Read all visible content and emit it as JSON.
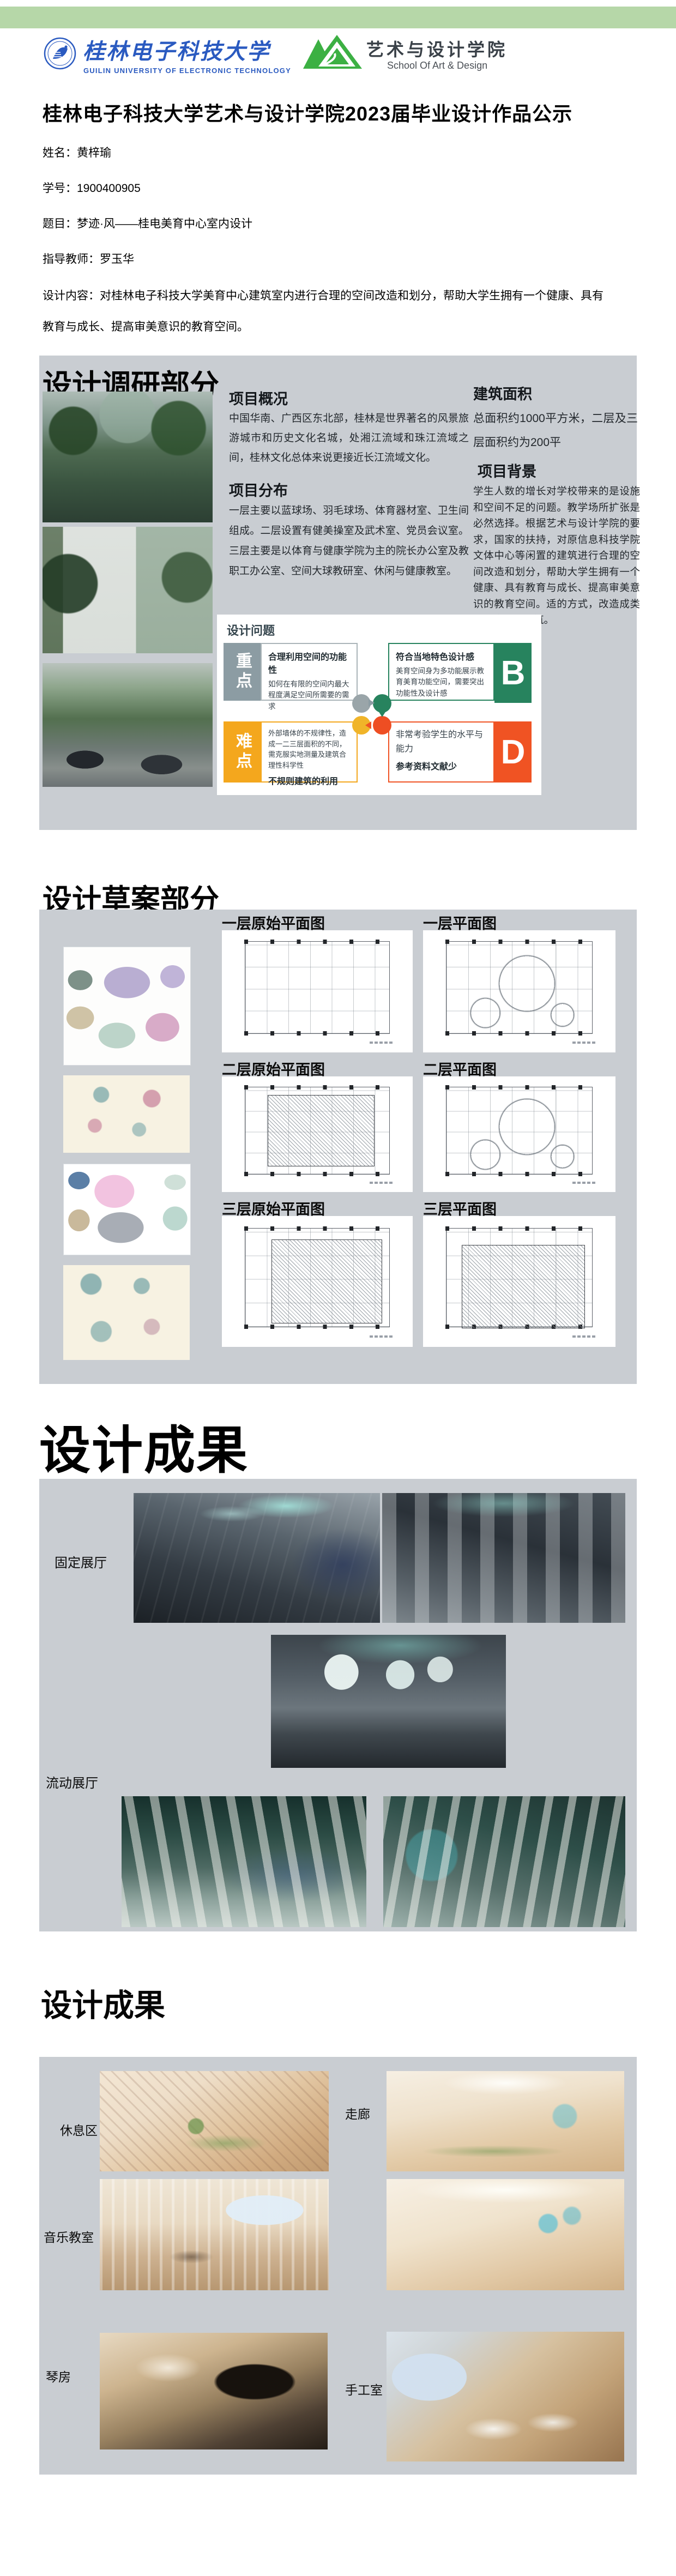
{
  "page": {
    "title": "桂林电子科技大学艺术与设计学院2023届毕业设计作品公示"
  },
  "header": {
    "university": {
      "name_cn": "桂林电子科技大学",
      "name_en": "GUILIN UNIVERSITY OF ELECTRONIC TECHNOLOGY"
    },
    "school": {
      "name_cn": "艺术与设计学院",
      "name_en": "School Of Art & Design"
    }
  },
  "info": {
    "rows": [
      {
        "label": "姓名：",
        "value": "黄梓瑜"
      },
      {
        "label": "学号：",
        "value": "1900400905"
      },
      {
        "label": "题目：",
        "value": "梦迹·风——桂电美育中心室内设计"
      },
      {
        "label": "指导教师：",
        "value": "罗玉华"
      },
      {
        "label": "设计内容：",
        "value": "对桂林电子科技大学美育中心建筑室内进行合理的空间改造和划分，帮助大学生拥有一个健康、具有教育与成长、提高审美意识的教育空间。"
      }
    ]
  },
  "research": {
    "title": "设计调研部分",
    "overview": {
      "heading": "项目概况",
      "body": "中国华南、广西区东北部，桂林是世界著名的风景旅游城市和历史文化名城，处湘江流域和珠江流域之间，桂林文化总体来说更接近长江流域文化。"
    },
    "distribution": {
      "heading": "项目分布",
      "body": "一层主要以蓝球场、羽毛球场、体育器材室、卫生间组成。二层设置有健美操室及武术室、党员会议室。三层主要是以体育与健康学院为主的院长办公室及教职工办公室、空间大球教研室、休闲与健康教室。"
    },
    "area": {
      "heading": "建筑面积",
      "body": "总面积约1000平方米，二层及三层面积约为200平"
    },
    "background": {
      "heading": "项目背景",
      "body": "学生人数的增长对学校带来的是设施和空间不足的问题。教学场所扩张是必然选择。根据艺术与设计学院的要求，国家的扶持，对原信息科技学院文体中心等闲置的建筑进行合理的空间改造和划分，帮助大学生拥有一个健康、具有教育与成长、提高审美意识的教育空间。适的方式，改造成类似美育中心建筑。"
    },
    "problems": {
      "heading": "设计问题",
      "key_label": "重点",
      "difficulty_label": "难点",
      "q1": {
        "title": "合理利用空间的功能性",
        "body": "如何在有限的空间内最大程度满足空间所需要的需求"
      },
      "q2": {
        "title": "符合当地特色设计感",
        "body": "美育空间身为多功能展示教育美育功能空间，需要突出功能性及设计感",
        "badge": "B"
      },
      "q3": {
        "body": "外部墙体的不规律性，造成一二三层面积的不同，需克服实地测量及建筑合理性科学性",
        "title": "不规则建筑的利用"
      },
      "q4": {
        "body": "非常考验学生的水平与能力",
        "title": "参考资料文献少",
        "badge": "D"
      }
    }
  },
  "draft": {
    "title": "设计草案部分",
    "plans": [
      {
        "label": "一层原始平面图"
      },
      {
        "label": "一层平面图"
      },
      {
        "label": "二层原始平面图"
      },
      {
        "label": "二层平面图"
      },
      {
        "label": "三层原始平面图"
      },
      {
        "label": "三层平面图"
      }
    ]
  },
  "results_exhibition": {
    "title": "设计成果",
    "labels": {
      "fixed": "固定展厅",
      "mobile": "流动展厅"
    }
  },
  "results_rooms": {
    "title": "设计成果",
    "labels": {
      "rest": "休息区",
      "corridor": "走廊",
      "music": "音乐教室",
      "piano": "琴房",
      "craft": "手工室"
    }
  },
  "colors": {
    "header_bar": "#b6d7a8",
    "section_bg": "#c9cdd2",
    "university_blue": "#2a5ac0",
    "school_green": "#3cb043",
    "key_block": "#8c9ca3",
    "difficulty_block": "#f4a71d",
    "badge_b": "#27835e",
    "badge_d": "#f05323"
  }
}
